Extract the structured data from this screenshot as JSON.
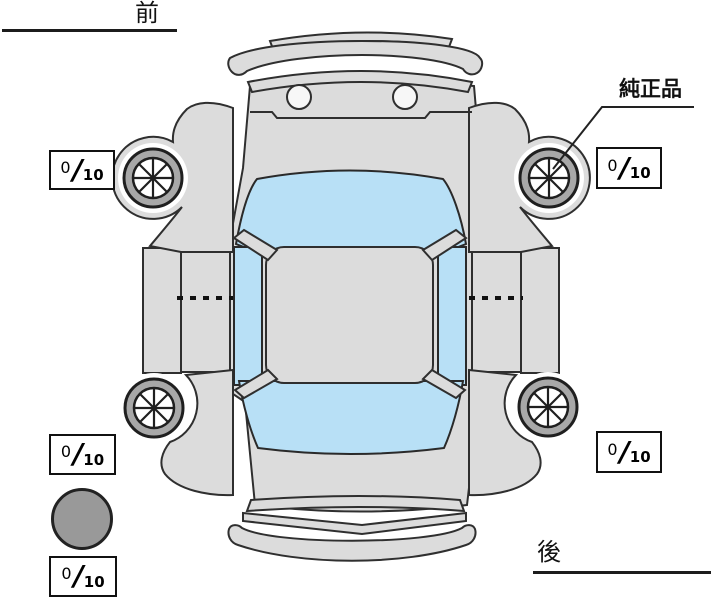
{
  "labels": {
    "front": "前",
    "rear": "後",
    "genuine_part": "純正品"
  },
  "tread_scores": {
    "separator": "/",
    "front_left": {
      "value": "0",
      "max": "10"
    },
    "front_right": {
      "value": "0",
      "max": "10"
    },
    "rear_left": {
      "value": "0",
      "max": "10"
    },
    "rear_right": {
      "value": "0",
      "max": "10"
    },
    "spare": {
      "value": "0",
      "max": "10"
    }
  },
  "diagram": {
    "type": "car-top-view-inspection",
    "wheel_count": 4,
    "spare_tire_marker": true,
    "colors": {
      "body": "#dcdcdc",
      "window": "#b8e0f6",
      "tire": "#a8a8a8",
      "spare": "#999999",
      "outline": "#2f2f2f",
      "background": "#ffffff"
    }
  }
}
